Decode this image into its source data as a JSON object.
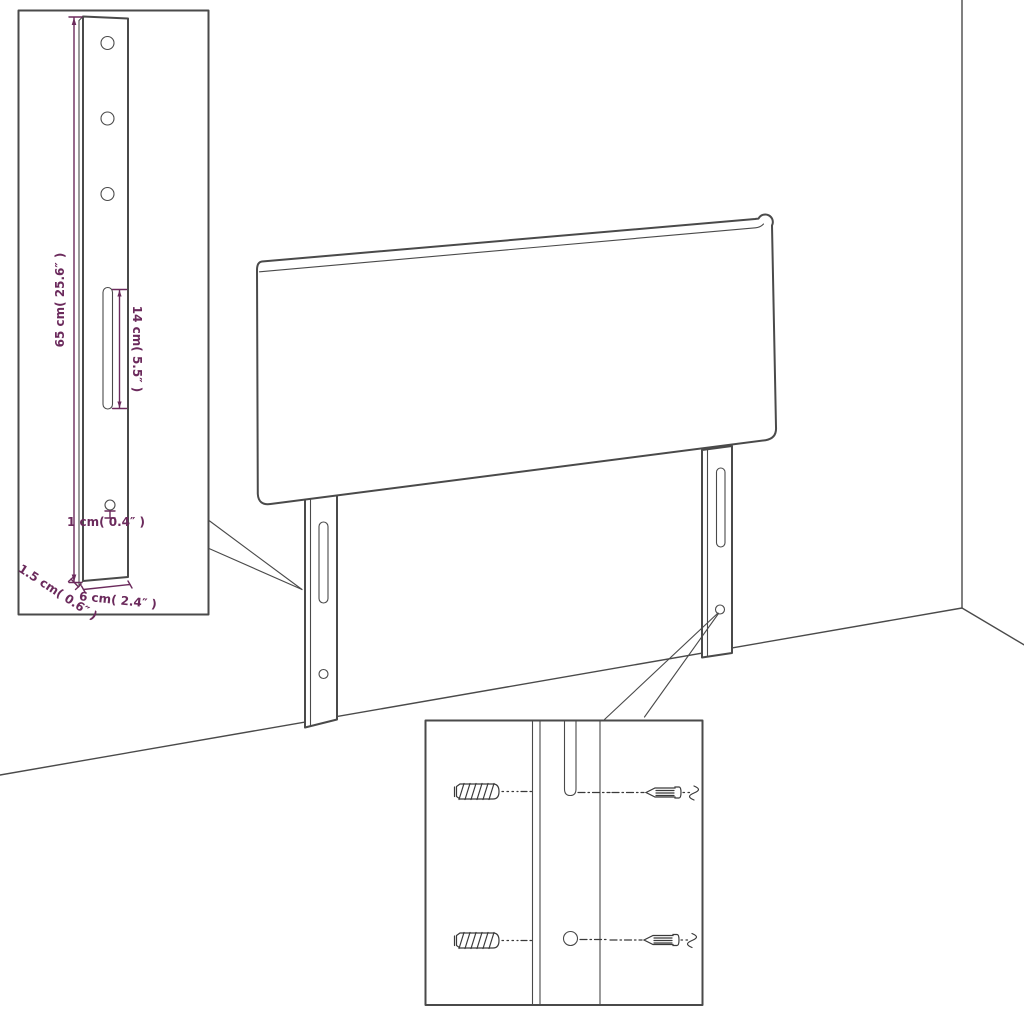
{
  "colors": {
    "background": "#ffffff",
    "line": "#4a4a4a",
    "dimension": "#6b2a5c"
  },
  "labels": {
    "leg_height": "65 cm( 25.6″ )",
    "slot_length": "14 cm( 5.5″ )",
    "hole_diameter": "1 cm( 0.4″ )",
    "leg_thickness": "1.5 cm( 0.6″ )",
    "leg_width": "6 cm( 2.4″ )"
  },
  "icons": {
    "wall_plug": "wall-plug-icon",
    "screw": "screw-icon"
  }
}
